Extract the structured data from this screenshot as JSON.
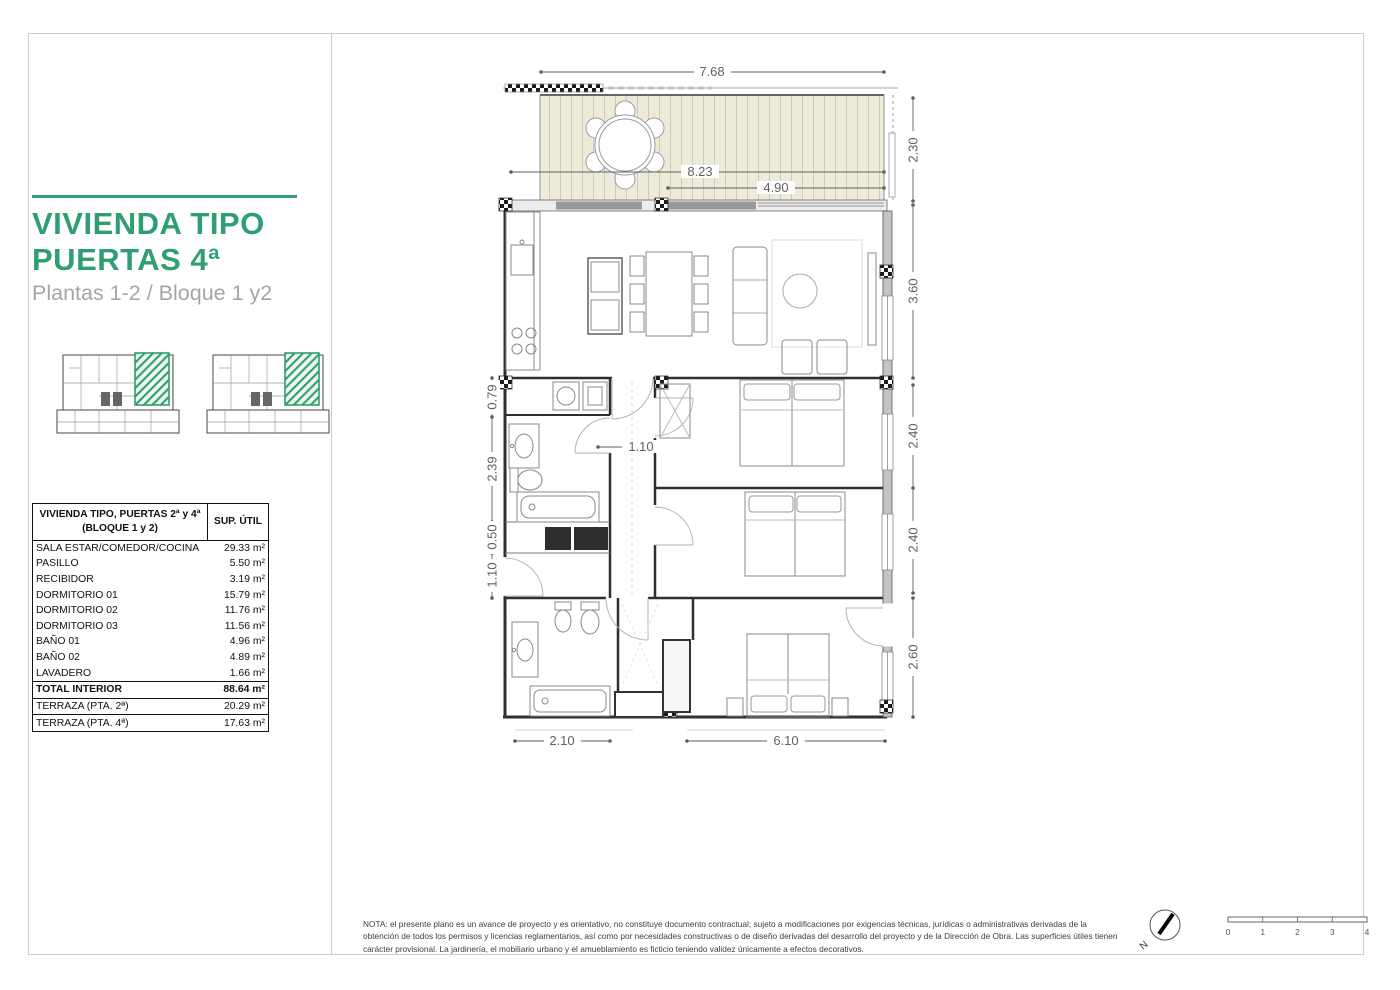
{
  "page": {
    "accent": "#2f9e70"
  },
  "sidebar": {
    "title_line1": "VIVIENDA TIPO",
    "title_line2": "PUERTAS 4ª",
    "subtitle": "Plantas 1-2 / Bloque 1 y2"
  },
  "table": {
    "header": {
      "col1_line1": "VIVIENDA TIPO, PUERTAS 2ª y 4ª",
      "col1_line2": "(BLOQUE 1 y 2)",
      "col2": "SUP. ÚTIL"
    },
    "rows": [
      {
        "label": "SALA ESTAR/COMEDOR/COCINA",
        "value": "29.33 m²"
      },
      {
        "label": "PASILLO",
        "value": "5.50 m²"
      },
      {
        "label": "RECIBIDOR",
        "value": "3.19 m²"
      },
      {
        "label": "DORMITORIO 01",
        "value": "15.79 m²"
      },
      {
        "label": "DORMITORIO 02",
        "value": "11.76 m²"
      },
      {
        "label": "DORMITORIO 03",
        "value": "11.56 m²"
      },
      {
        "label": "BAÑO 01",
        "value": "4.96 m²"
      },
      {
        "label": "BAÑO 02",
        "value": "4.89 m²"
      },
      {
        "label": "LAVADERO",
        "value": "1.66 m²"
      }
    ],
    "total": {
      "label": "TOTAL INTERIOR",
      "value": "88.64 m²"
    },
    "terrace_rows": [
      {
        "label": "TERRAZA (PTA. 2ª)",
        "value": "20.29 m²"
      },
      {
        "label": "TERRAZA (PTA. 4ª)",
        "value": "17.63 m²"
      }
    ]
  },
  "plan": {
    "dims": {
      "top_width": "7.68",
      "terrace_full": "8.23",
      "terrace_part": "4.90",
      "right_terrace": "2.30",
      "right_living": "3.60",
      "right_dorm02": "2.40",
      "right_dorm03": "2.40",
      "right_dorm01": "2.60",
      "left_lavadero": "0.79",
      "left_bano": "2.39",
      "left_closet": "0.50",
      "left_entry": "1.10",
      "hallway": "1.10",
      "bottom_left": "2.10",
      "bottom_right": "6.10"
    }
  },
  "footer": {
    "note": "NOTA: el presente plano es un avance de proyecto y es orientativo, no constituye documento contractual; sujeto a modificaciones por exigencias técnicas, jurídicas o administrativas derivadas de la obtención de todos los permisos y licencias reglamentarios, así como por necesidades constructivas o de diseño derivadas del desarrollo del proyecto y de la Dirección de Obra. Las superficies útiles tienen carácter provisional. La jardinería, el mobiliario urbano y el amueblamiento es ficticio teniendo validez únicamente a efectos decorativos.",
    "north_label": "N",
    "scale_ticks": [
      "0",
      "1",
      "2",
      "3",
      "4"
    ]
  }
}
